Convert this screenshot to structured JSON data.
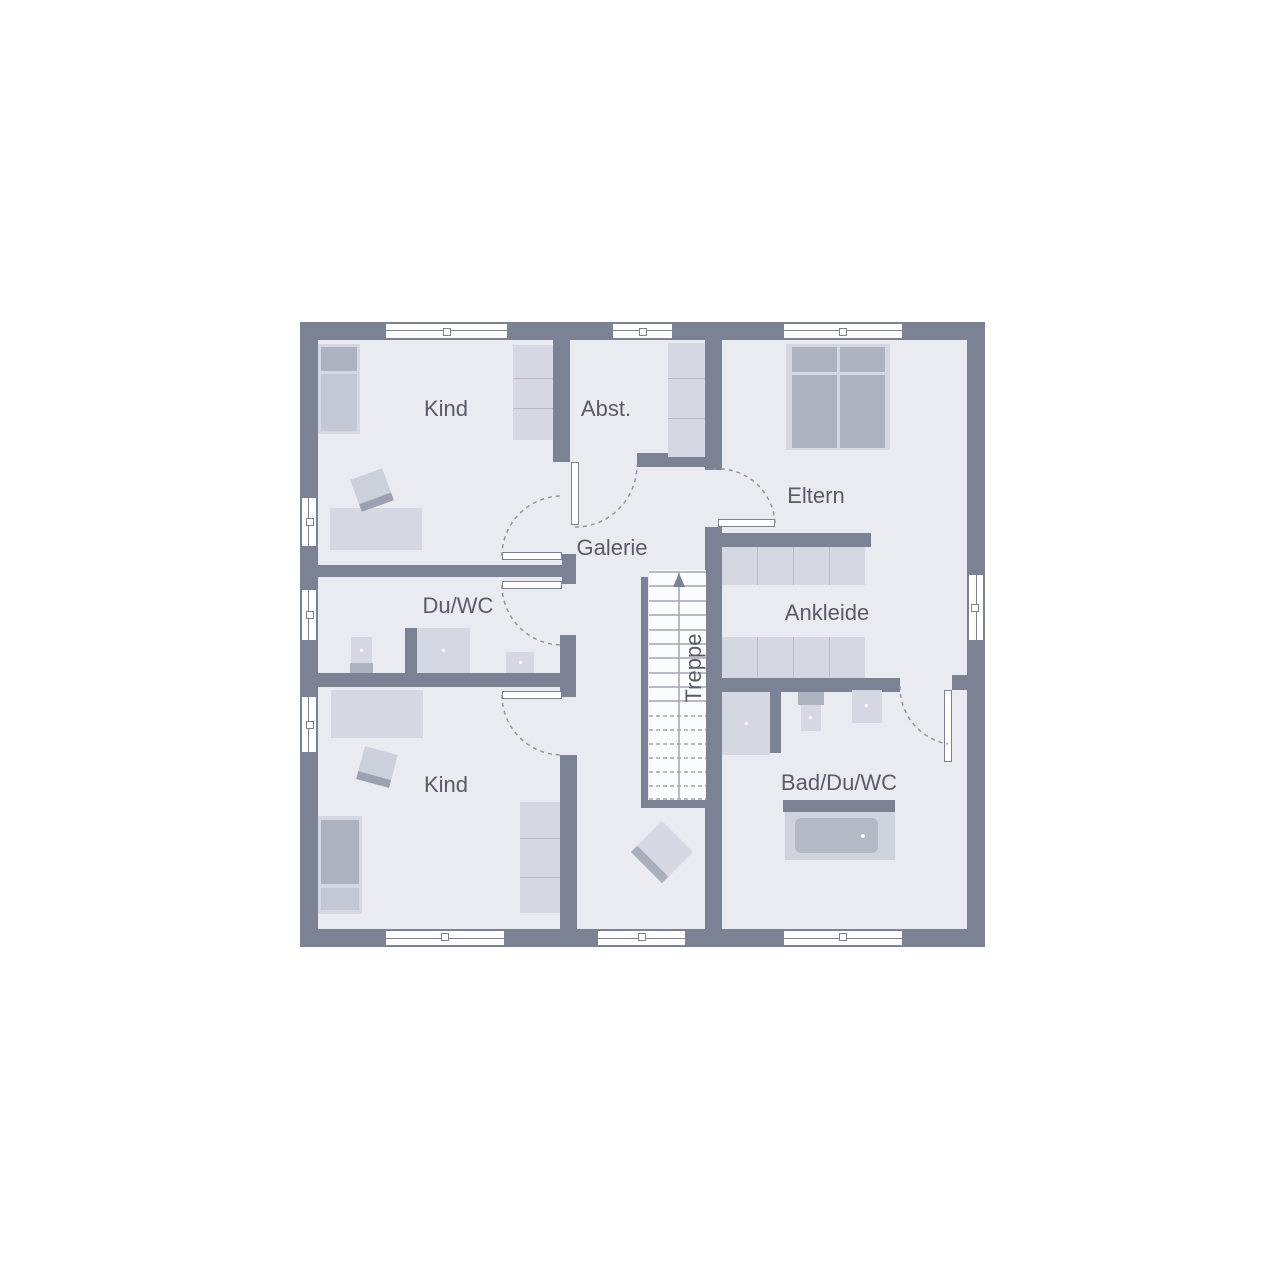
{
  "plan": {
    "type": "floor-plan",
    "rooms": [
      {
        "id": "kind-top",
        "label": "Kind"
      },
      {
        "id": "abstellraum",
        "label": "Abst."
      },
      {
        "id": "eltern",
        "label": "Eltern"
      },
      {
        "id": "galerie",
        "label": "Galerie"
      },
      {
        "id": "du-wc",
        "label": "Du/WC"
      },
      {
        "id": "ankleide",
        "label": "Ankleide"
      },
      {
        "id": "treppe",
        "label": "Treppe"
      },
      {
        "id": "kind-bottom",
        "label": "Kind"
      },
      {
        "id": "bad-du-wc",
        "label": "Bad/Du/WC"
      }
    ],
    "colors": {
      "wall": "#7a8294",
      "floor": "#e9ebf1",
      "furniture_light": "#d5d8e2",
      "furniture_medium": "#adb2c1",
      "label_text": "#575c68",
      "background": "#ffffff"
    }
  }
}
